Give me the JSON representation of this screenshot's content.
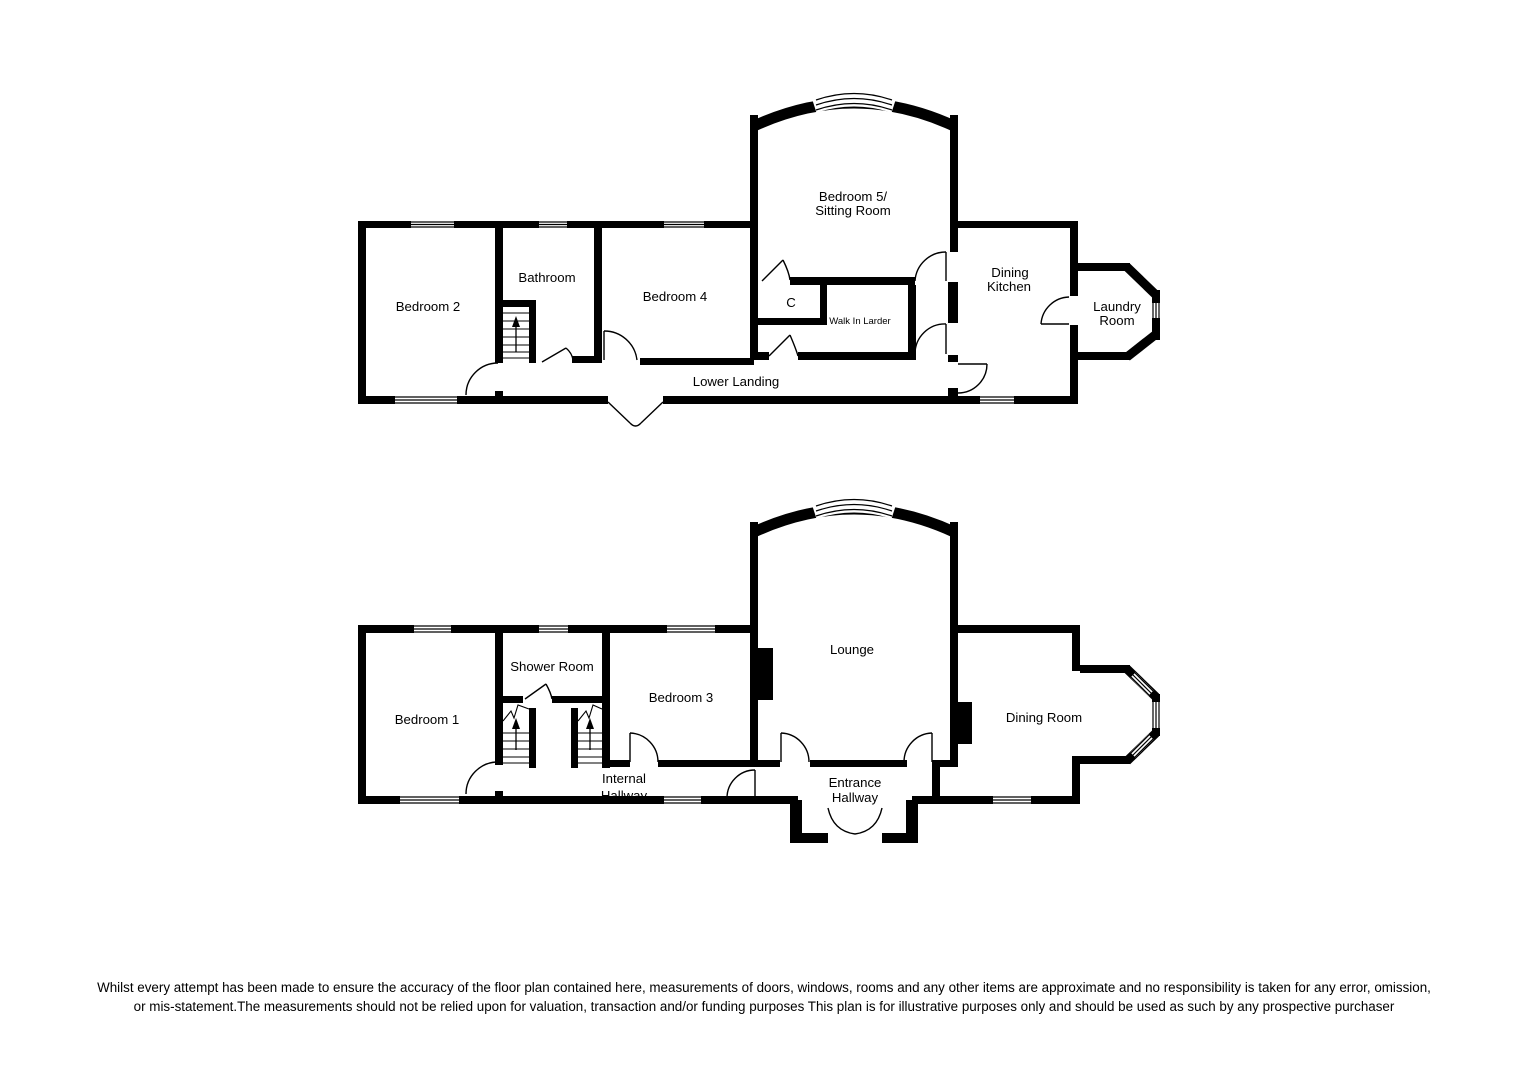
{
  "document": {
    "type": "floorplan",
    "background_color": "#ffffff",
    "wall_color": "#000000",
    "text_color": "#000000"
  },
  "floors": {
    "upper": {
      "bedroom2": "Bedroom 2",
      "bathroom": "Bathroom",
      "bedroom4": "Bedroom 4",
      "bedroom5_line1": "Bedroom 5/",
      "bedroom5_line2": "Sitting Room",
      "closet": "C",
      "walk_in_larder": "Walk In Larder",
      "dining_kitchen_line1": "Dining",
      "dining_kitchen_line2": "Kitchen",
      "laundry_line1": "Laundry",
      "laundry_line2": "Room",
      "lower_landing": "Lower Landing"
    },
    "ground": {
      "bedroom1": "Bedroom 1",
      "shower_room": "Shower Room",
      "bedroom3": "Bedroom 3",
      "lounge": "Lounge",
      "dining_room": "Dining Room",
      "internal_hallway_line1": "Internal",
      "internal_hallway_line2": "Hallway",
      "entrance_hallway_line1": "Entrance",
      "entrance_hallway_line2": "Hallway"
    }
  },
  "disclaimer": {
    "line1": "Whilst every attempt has been made to ensure the accuracy of the floor plan contained here, measurements of doors, windows, rooms and any other items are approximate and no responsibility is taken for any error, omission,",
    "line2": "or mis-statement.The measurements should not be relied upon for valuation, transaction and/or funding purposes This plan is for illustrative purposes only and should be used as such by any prospective purchaser"
  }
}
